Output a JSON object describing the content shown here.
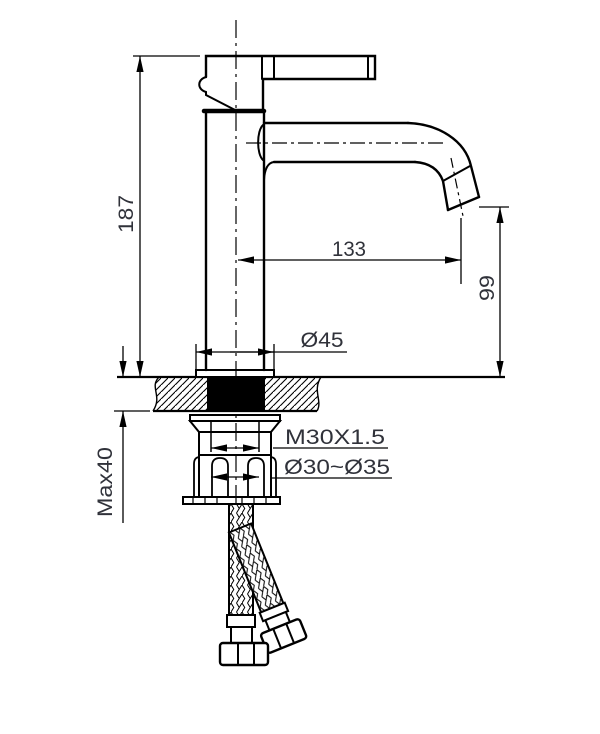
{
  "drawing": {
    "type": "faucet installation dimension drawing",
    "colors": {
      "line": "#000000",
      "text": "#30323a",
      "background": "#ffffff",
      "section_fill": "#000000"
    },
    "dimensions": {
      "overall_height": "187",
      "spout_reach": "133",
      "outlet_height": "99",
      "base_diameter": "Ø45",
      "mounting_thread": "M30X1.5",
      "mounting_hole_range": "Ø30~Ø35",
      "max_counter_thickness": "Max40"
    }
  }
}
